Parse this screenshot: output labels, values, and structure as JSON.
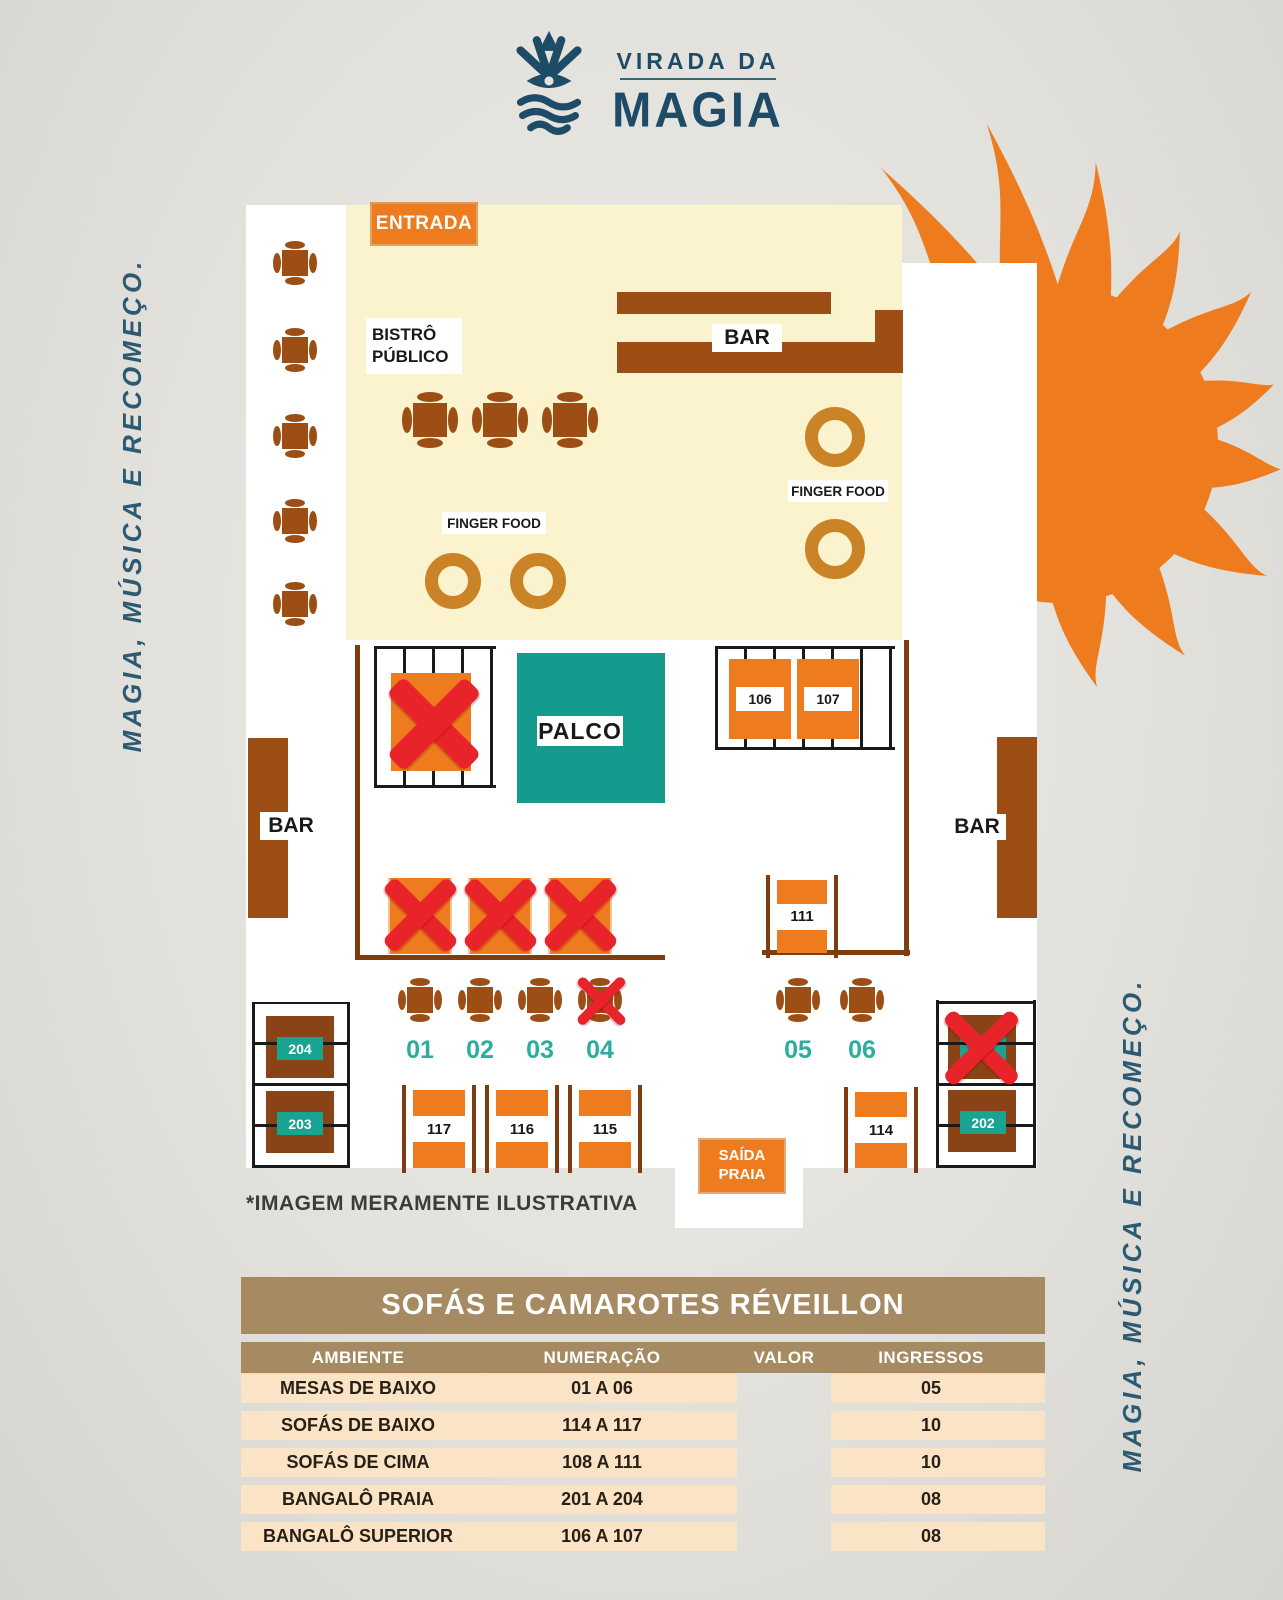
{
  "logo": {
    "top": "VIRADA DA",
    "bottom": "MAGIA"
  },
  "side_text": {
    "left": "MAGIA, MÚSICA E RECOMEÇO.",
    "right": "MAGIA, MÚSICA E RECOMEÇO."
  },
  "map": {
    "entrada": "ENTRADA",
    "bistro": "BISTRÔ\nPÚBLICO",
    "bar_top": "BAR",
    "bar_left": "BAR",
    "bar_right": "BAR",
    "finger_food_left": "FINGER FOOD",
    "finger_food_right": "FINGER FOOD",
    "palco": "PALCO",
    "saida": "SAÍDA\nPRAIA",
    "bangalo_superior": {
      "b106": "106",
      "b107": "107"
    },
    "sofa_111": "111",
    "mesas": [
      "01",
      "02",
      "03",
      "04",
      "05",
      "06"
    ],
    "sofas_baixo": {
      "s117": "117",
      "s116": "116",
      "s115": "115",
      "s114": "114"
    },
    "bangalo_praia": {
      "b204": "204",
      "b203": "203",
      "b202": "202"
    },
    "disclaimer": "*IMAGEM MERAMENTE ILUSTRATIVA"
  },
  "pricing": {
    "title": "SOFÁS E CAMAROTES RÉVEILLON",
    "columns": [
      "AMBIENTE",
      "NUMERAÇÃO",
      "VALOR",
      "INGRESSOS"
    ],
    "rows": [
      {
        "ambiente": "MESAS DE BAIXO",
        "numeracao": "01 A 06",
        "valor": "",
        "ingressos": "05"
      },
      {
        "ambiente": "SOFÁS DE BAIXO",
        "numeracao": "114 A 117",
        "valor": "",
        "ingressos": "10"
      },
      {
        "ambiente": "SOFÁS DE CIMA",
        "numeracao": "108 A 111",
        "valor": "",
        "ingressos": "10"
      },
      {
        "ambiente": "BANGALÔ PRAIA",
        "numeracao": "201 A 204",
        "valor": "",
        "ingressos": "08"
      },
      {
        "ambiente": "BANGALÔ SUPERIOR",
        "numeracao": "106 A 107",
        "valor": "",
        "ingressos": "08"
      }
    ]
  },
  "colors": {
    "orange": "#ee7b1e",
    "brown": "#9d4e14",
    "darkbrown": "#8a4317",
    "wall": "#7e3c10",
    "golden": "#cb8327",
    "teal": "#159b8d",
    "teallabel": "#18a393",
    "tealnum": "#2aae9d",
    "red": "#e8232a",
    "cream": "#fbf3cd",
    "navy": "#1e4b66",
    "navy2": "#2b5a72",
    "tan": "#a68a62",
    "peach": "#fbe4c6"
  }
}
